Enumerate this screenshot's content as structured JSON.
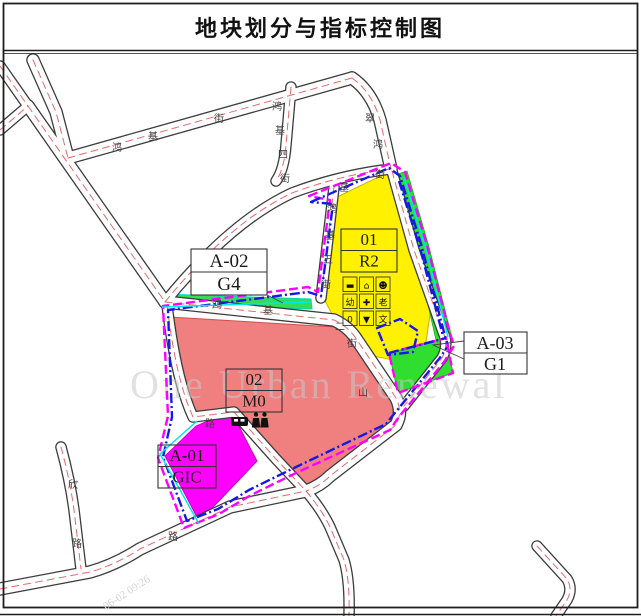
{
  "title": "地块划分与指标控制图",
  "watermarks": {
    "brand": "One Urban Renewal",
    "stamp": "06-02 09:26"
  },
  "colors": {
    "residential_yellow": "#FFF100",
    "industrial_red": "#F07F7F",
    "gic_magenta": "#FF00FF",
    "green_space": "#2FDE2F",
    "green_strip": "#35DC55",
    "boundary_magenta": "#FF00FF",
    "boundary_blue": "#1818E6",
    "boundary_cyan": "#00E8E8",
    "road_centerline_red": "#E26B6B"
  },
  "plots": {
    "r2": {
      "no": "01",
      "use": "R2"
    },
    "m0": {
      "no": "02",
      "use": "M0"
    },
    "a01": {
      "no": "A-01",
      "use": "GIC"
    },
    "a02": {
      "no": "A-02",
      "use": "G4"
    },
    "a03": {
      "no": "A-03",
      "use": "G1"
    }
  },
  "facility_icons": {
    "r2_grid": [
      "▬",
      "⌂",
      "☻",
      "幼",
      "✚",
      "老",
      "0",
      "▼",
      "文"
    ],
    "m0_row": [
      "bus-station",
      "public-toilet"
    ]
  },
  "street_chars": [
    "鸿",
    "基",
    "街",
    "鸿",
    "基",
    "四",
    "街",
    "翠",
    "鸿",
    "基",
    "街",
    "鸿",
    "基",
    "五",
    "街",
    "鸿",
    "基",
    "二",
    "街",
    "山",
    "欣",
    "路",
    "路",
    "路"
  ]
}
